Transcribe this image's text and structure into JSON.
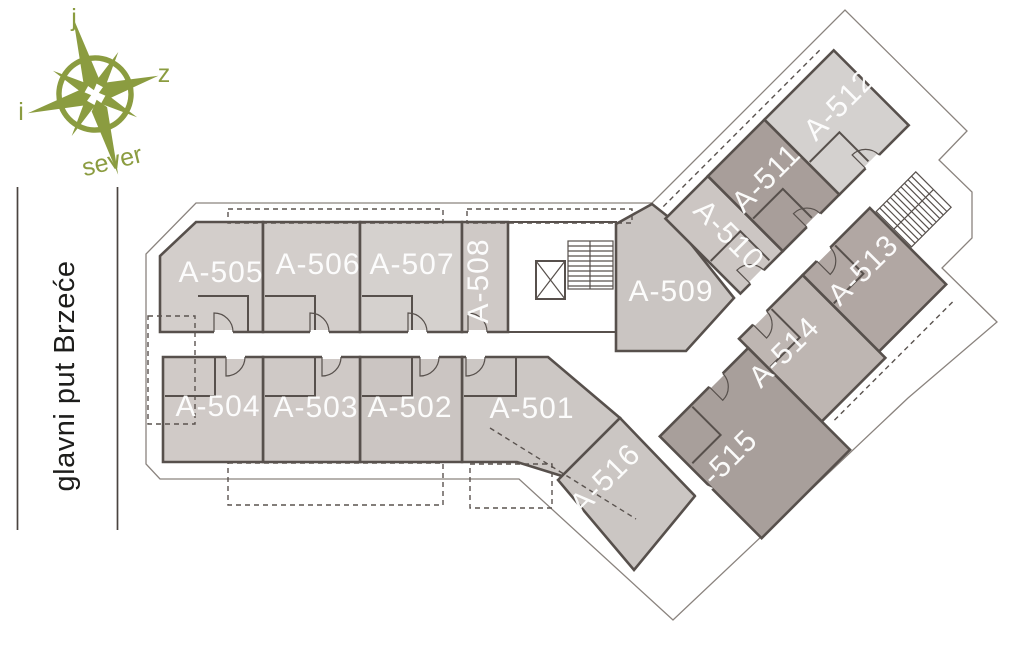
{
  "compass": {
    "top_letter": "j",
    "right_letter": "z",
    "left_letter": "i",
    "bottom_label": "sever",
    "color": "#8b9c40"
  },
  "street": {
    "name": "glavni put Brzeće",
    "text_color": "#1d1d1b",
    "line_color": "#4a4440"
  },
  "floorplan": {
    "background": "#ffffff",
    "wall_color": "#57504c",
    "roof_outline_color": "#8a837e",
    "label_color": "#ffffff",
    "rooms": [
      {
        "label": "A-501",
        "frame": "global",
        "points": "462,357 548,357 620,418 562,476 517,462 462,462",
        "fill": "#ccc7c4",
        "label_x": 532,
        "label_y": 418,
        "rotation": 0
      },
      {
        "label": "A-502",
        "frame": "global",
        "points": "360,357 462,357 462,462 360,462",
        "fill": "#cbc5c2",
        "label_x": 410,
        "label_y": 417,
        "rotation": 0
      },
      {
        "label": "A-503",
        "frame": "global",
        "points": "263,357 360,357 360,462 263,462",
        "fill": "#cfc9c6",
        "label_x": 316,
        "label_y": 417,
        "rotation": 0
      },
      {
        "label": "A-504",
        "frame": "global",
        "points": "163,357 263,357 263,462 163,462",
        "fill": "#d0cac7",
        "label_x": 218,
        "label_y": 416,
        "rotation": 0
      },
      {
        "label": "A-505",
        "frame": "global",
        "points": "196,222 263,222 263,332 160,332 160,256",
        "fill": "#d3cecb",
        "label_x": 221,
        "label_y": 282,
        "rotation": 0
      },
      {
        "label": "A-506",
        "frame": "global",
        "points": "263,222 360,222 360,332 263,332",
        "fill": "#d3cecb",
        "label_x": 318,
        "label_y": 274,
        "rotation": 0
      },
      {
        "label": "A-507",
        "frame": "global",
        "points": "360,222 462,222 462,332 360,332",
        "fill": "#d5d1ce",
        "label_x": 412,
        "label_y": 274,
        "rotation": 0
      },
      {
        "label": "A-508",
        "frame": "global",
        "points": "462,222 508,222 508,332 462,332",
        "fill": "#cfc9c6",
        "label_x": 488,
        "label_y": 281,
        "rotation": -90
      },
      {
        "label": "A-509",
        "frame": "global",
        "points": "616,224 652,204 671,219 734,298 686,351 616,351",
        "fill": "#cac5c2",
        "label_x": 671,
        "label_y": 301,
        "rotation": 0
      },
      {
        "label": "A-510",
        "frame": "wing",
        "points": "118,-82 178,-82 178,24 118,24",
        "fill": "#ccc6c3",
        "label_x": 722,
        "label_y": 242,
        "rotation": 45
      },
      {
        "label": "A-511",
        "frame": "wing",
        "points": "178,-82 258,-82 258,24 178,24",
        "fill": "#a89e9a",
        "label_x": 773,
        "label_y": 185,
        "rotation": -45
      },
      {
        "label": "A-512",
        "frame": "wing",
        "points": "258,-82 356,-82 356,24 258,24",
        "fill": "#d4d1cf",
        "label_x": 846,
        "label_y": 112,
        "rotation": -45
      },
      {
        "label": "A-513",
        "frame": "wing",
        "points": "175,55 270,55 270,163 175,163",
        "fill": "#b1a7a3",
        "label_x": 870,
        "label_y": 277,
        "rotation": -45
      },
      {
        "label": "A-514",
        "frame": "wing",
        "points": "85,55 175,55 175,172 85,172",
        "fill": "#beb6b2",
        "label_x": 791,
        "label_y": 359,
        "rotation": -45
      },
      {
        "label": "A-515",
        "frame": "wing",
        "points": "-40,68 85,68 85,212 -40,212",
        "fill": "#a89f9b",
        "label_x": 729,
        "label_y": 472,
        "rotation": -45
      },
      {
        "label": "A-516",
        "frame": "global",
        "points": "558,480 620,418 695,496 634,570",
        "fill": "#cbc6c3",
        "label_x": 612,
        "label_y": 486,
        "rotation": -45
      }
    ]
  }
}
